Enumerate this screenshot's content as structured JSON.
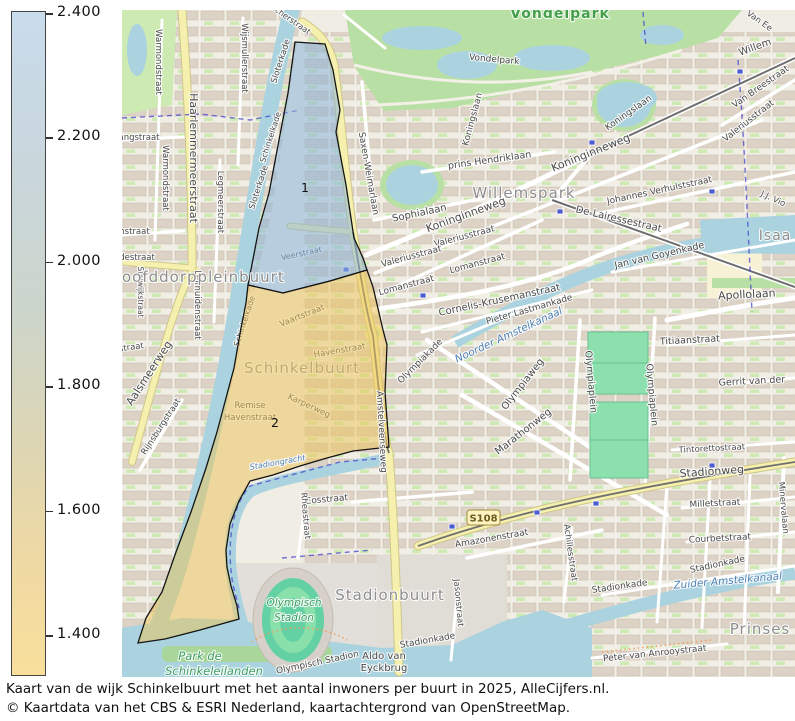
{
  "colorbar": {
    "ticks": [
      "2.400",
      "2.200",
      "2.000",
      "1.800",
      "1.600",
      "1.400"
    ],
    "top_color": "#c9dcec",
    "mid_color": "#ccd5cb",
    "bottom_color": "#f8df9c"
  },
  "caption": {
    "line1": "Kaart van de wijk Schinkelbuurt met het aantal inwoners per buurt in 2025, AlleCijfers.nl.",
    "line2": "© Kaartdata van het CBS & ESRI Nederland, kaartachtergrond van OpenStreetMap."
  },
  "regions": [
    {
      "id": "1",
      "number": "1",
      "fill": "rgba(139,181,216,0.55)",
      "nx": 183,
      "ny": 182
    },
    {
      "id": "2",
      "number": "2",
      "fill": "rgba(235,195,90,0.52)",
      "nx": 153,
      "ny": 417
    }
  ],
  "map": {
    "badge": {
      "text": "S108"
    },
    "labels_under": [
      {
        "t": "Veerstraat",
        "x": 180,
        "y": 246,
        "r": -12,
        "s": 8,
        "k": "street"
      },
      {
        "t": "Schinkelkade",
        "x": 151,
        "y": 128,
        "r": -72,
        "s": 8,
        "k": "street"
      },
      {
        "t": "Vaartstraat",
        "x": 181,
        "y": 308,
        "r": -22,
        "s": 8.5,
        "k": "street"
      },
      {
        "t": "Havenstraat",
        "x": 218,
        "y": 343,
        "r": -10,
        "s": 8.5,
        "k": "street"
      },
      {
        "t": "Karperweg",
        "x": 186,
        "y": 398,
        "r": 25,
        "s": 8.5,
        "k": "street"
      },
      {
        "t": "Schinkelkade",
        "x": 125,
        "y": 312,
        "r": -72,
        "s": 8,
        "k": "street"
      },
      {
        "t": "Remise",
        "x": 128,
        "y": 398,
        "r": 0,
        "s": 8.5,
        "k": "street"
      },
      {
        "t": "Havenstraat",
        "x": 128,
        "y": 410,
        "r": 0,
        "s": 8.5,
        "k": "street"
      },
      {
        "t": "Schinkelbuurt",
        "x": 180,
        "y": 363,
        "r": 0,
        "s": 15,
        "k": "area"
      }
    ],
    "street_labels": [
      {
        "t": "Warmondstraat",
        "x": 34,
        "y": 52,
        "r": 90,
        "s": 8.5
      },
      {
        "t": "Wijsmullerstraat",
        "x": 120,
        "y": 48,
        "r": 90,
        "s": 8.5
      },
      {
        "t": "Haarlemmermeerstraat",
        "x": 68,
        "y": 148,
        "r": 90,
        "s": 11
      },
      {
        "t": "Warmondstraat",
        "x": 41,
        "y": 168,
        "r": 90,
        "s": 8.5
      },
      {
        "t": "Legmeerstraat",
        "x": 96,
        "y": 192,
        "r": 90,
        "s": 8.5
      },
      {
        "t": "angstraat",
        "x": 17,
        "y": 130,
        "r": 0,
        "s": 8.5
      },
      {
        "t": "mstraat",
        "x": 11,
        "y": 224,
        "r": 0,
        "s": 8.5
      },
      {
        "t": "destraat",
        "x": 15,
        "y": 250,
        "r": 0,
        "s": 8.5
      },
      {
        "t": "Stolwijkstraat",
        "x": 16,
        "y": 282,
        "r": 90,
        "s": 7.5
      },
      {
        "t": "rstraat",
        "x": 8,
        "y": 340,
        "r": -8,
        "s": 8.5
      },
      {
        "t": "Aalsmeerweg",
        "x": 30,
        "y": 365,
        "r": -57,
        "s": 11
      },
      {
        "t": "Rijnsburgstraat",
        "x": 41,
        "y": 418,
        "r": -57,
        "s": 8.5
      },
      {
        "t": "Leimuidenstraat",
        "x": 73,
        "y": 295,
        "r": 90,
        "s": 8.5
      },
      {
        "t": "Sloterkade",
        "x": 161,
        "y": 52,
        "r": -72,
        "s": 8.5
      },
      {
        "t": "Sloterkade",
        "x": 139,
        "y": 178,
        "r": -72,
        "s": 8.5
      },
      {
        "t": "Zocherstraat",
        "x": 165,
        "y": 10,
        "r": 35,
        "s": 8
      },
      {
        "t": "Vondelpark",
        "x": 372,
        "y": 52,
        "r": 5,
        "s": 9
      },
      {
        "t": "Koningslaan",
        "x": 353,
        "y": 110,
        "r": -75,
        "s": 9
      },
      {
        "t": "Koningslaan",
        "x": 508,
        "y": 105,
        "r": -35,
        "s": 9
      },
      {
        "t": "Koninginneweg",
        "x": 345,
        "y": 208,
        "r": -20,
        "s": 11
      },
      {
        "t": "Koninginneweg",
        "x": 470,
        "y": 146,
        "r": -22,
        "s": 11
      },
      {
        "t": "prins Hendriklaan",
        "x": 368,
        "y": 153,
        "r": -8,
        "s": 9.5
      },
      {
        "t": "Sophialaan",
        "x": 298,
        "y": 206,
        "r": -12,
        "s": 10
      },
      {
        "t": "Saxen-Weimarlaan",
        "x": 244,
        "y": 164,
        "r": 80,
        "s": 9
      },
      {
        "t": "Valeriusstraat",
        "x": 343,
        "y": 229,
        "r": -15,
        "s": 9
      },
      {
        "t": "Valeriusstraat",
        "x": 290,
        "y": 249,
        "r": -15,
        "s": 9
      },
      {
        "t": "Valeriusstraat",
        "x": 628,
        "y": 113,
        "r": -38,
        "s": 9
      },
      {
        "t": "Lomanstraat",
        "x": 285,
        "y": 278,
        "r": -15,
        "s": 9
      },
      {
        "t": "Lomanstraat",
        "x": 356,
        "y": 256,
        "r": -15,
        "s": 9
      },
      {
        "t": "Van Breestraat",
        "x": 640,
        "y": 79,
        "r": -35,
        "s": 9
      },
      {
        "t": "Willem",
        "x": 634,
        "y": 40,
        "r": -20,
        "s": 10
      },
      {
        "t": "Van Ee",
        "x": 636,
        "y": 13,
        "r": 35,
        "s": 8.5
      },
      {
        "t": "Johannes Verhulststraat",
        "x": 538,
        "y": 183,
        "r": -12,
        "s": 9
      },
      {
        "t": "De-Lairessestraat",
        "x": 496,
        "y": 212,
        "r": 13,
        "s": 10
      },
      {
        "t": "J.J. Vio",
        "x": 650,
        "y": 191,
        "r": 25,
        "s": 8.5
      },
      {
        "t": "Cornelis-Krusemanstraat",
        "x": 378,
        "y": 293,
        "r": -12,
        "s": 10
      },
      {
        "t": "Pieter Lastmankade",
        "x": 408,
        "y": 302,
        "r": -16,
        "s": 9
      },
      {
        "t": "Jan van Goyenkade",
        "x": 538,
        "y": 248,
        "r": -13,
        "s": 9.5
      },
      {
        "t": "Apollolaan",
        "x": 625,
        "y": 288,
        "r": -3,
        "s": 11
      },
      {
        "t": "Titiaanstraat",
        "x": 568,
        "y": 333,
        "r": -3,
        "s": 9.5
      },
      {
        "t": "Gerrit van der",
        "x": 630,
        "y": 374,
        "r": -3,
        "s": 9.5
      },
      {
        "t": "Olympiakade",
        "x": 300,
        "y": 353,
        "r": -45,
        "s": 9
      },
      {
        "t": "Olympiaplein",
        "x": 466,
        "y": 372,
        "r": 85,
        "s": 9.5
      },
      {
        "t": "Olympiaplein",
        "x": 527,
        "y": 385,
        "r": 85,
        "s": 9.5
      },
      {
        "t": "Olympiaweg",
        "x": 403,
        "y": 376,
        "r": -52,
        "s": 10
      },
      {
        "t": "Marathonweg",
        "x": 403,
        "y": 424,
        "r": -38,
        "s": 10
      },
      {
        "t": "Milletstraat",
        "x": 593,
        "y": 496,
        "r": -3,
        "s": 9
      },
      {
        "t": "Courbetstraat",
        "x": 598,
        "y": 531,
        "r": -3,
        "s": 9
      },
      {
        "t": "Tintorettostraat",
        "x": 590,
        "y": 441,
        "r": -3,
        "s": 8.5
      },
      {
        "t": "Minervalaan",
        "x": 659,
        "y": 498,
        "r": 85,
        "s": 8.5
      },
      {
        "t": "Stadionweg",
        "x": 590,
        "y": 465,
        "r": -4,
        "s": 11
      },
      {
        "t": "Amazonenstraat",
        "x": 370,
        "y": 531,
        "r": -10,
        "s": 9
      },
      {
        "t": "Achillesstraat",
        "x": 446,
        "y": 543,
        "r": 82,
        "s": 8.5
      },
      {
        "t": "Stadionkade",
        "x": 498,
        "y": 579,
        "r": -8,
        "s": 9
      },
      {
        "t": "Stadionkade",
        "x": 596,
        "y": 557,
        "r": -12,
        "s": 9
      },
      {
        "t": "Stadionkade",
        "x": 306,
        "y": 633,
        "r": -10,
        "s": 9
      },
      {
        "t": "Peter van Anrooystraat",
        "x": 533,
        "y": 646,
        "r": -6,
        "s": 9
      },
      {
        "t": "Aldo van",
        "x": 262,
        "y": 649,
        "r": 0,
        "s": 10,
        "c": "#333333"
      },
      {
        "t": "Eyckbrug",
        "x": 262,
        "y": 661,
        "r": 0,
        "s": 10,
        "c": "#333333"
      },
      {
        "t": "Olympisch Stadion",
        "x": 196,
        "y": 655,
        "r": -12,
        "s": 9
      },
      {
        "t": "Eosstraat",
        "x": 205,
        "y": 492,
        "r": -5,
        "s": 9
      },
      {
        "t": "Rheastraat",
        "x": 181,
        "y": 506,
        "r": 85,
        "s": 8.5
      },
      {
        "t": "Jasonstraat",
        "x": 334,
        "y": 593,
        "r": 85,
        "s": 8.5
      },
      {
        "t": "Amstelveenseweg",
        "x": 257,
        "y": 422,
        "r": 87,
        "s": 9
      }
    ],
    "area_labels": [
      {
        "t": "oofddorppleinbuurt",
        "x": 0,
        "y": 272,
        "s": 15,
        "a": "s"
      },
      {
        "t": "Willemspark",
        "x": 402,
        "y": 188,
        "s": 15
      },
      {
        "t": "Stadionbuurt",
        "x": 268,
        "y": 590,
        "s": 15
      },
      {
        "t": "Prinses",
        "x": 638,
        "y": 624,
        "s": 15
      },
      {
        "t": "Isaa",
        "x": 653,
        "y": 230,
        "s": 14
      }
    ],
    "water_labels": [
      {
        "t": "Noorder Amstelkanaal",
        "x": 388,
        "y": 328,
        "r": -25,
        "s": 10.5
      },
      {
        "t": "Zuider Amstelkanaal",
        "x": 606,
        "y": 574,
        "r": -5,
        "s": 10.5
      },
      {
        "t": "Stadiongracht",
        "x": 156,
        "y": 455,
        "r": -10,
        "s": 8
      }
    ],
    "park_labels": [
      {
        "t": "Vondelpark",
        "x": 438,
        "y": 8,
        "s": 14,
        "k": "big"
      },
      {
        "t": "Park de",
        "x": 78,
        "y": 650,
        "s": 11.5
      },
      {
        "t": "Schinkeleilanden",
        "x": 92,
        "y": 665,
        "s": 11.5
      },
      {
        "t": "Olympisch",
        "x": 172,
        "y": 596,
        "s": 10.5
      },
      {
        "t": "Stadion",
        "x": 172,
        "y": 611,
        "s": 10.5
      }
    ]
  }
}
